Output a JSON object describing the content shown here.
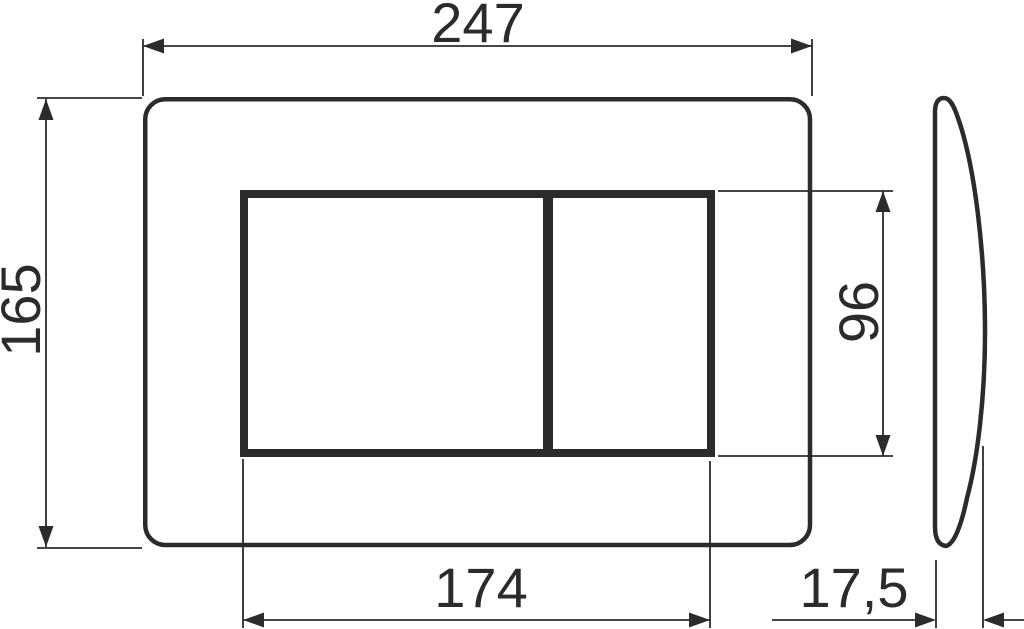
{
  "drawing": {
    "title": "flush-plate-dimension-drawing",
    "line_color": "#2b2b2b",
    "background_color": "#ffffff",
    "views": {
      "front": "flush-plate-front-view-with-two-buttons",
      "side": "flush-plate-side-profile"
    },
    "dimensions": {
      "overall_width": "247",
      "overall_height": "165",
      "button_area_width": "174",
      "button_area_height": "96",
      "plate_depth": "17,5"
    }
  }
}
